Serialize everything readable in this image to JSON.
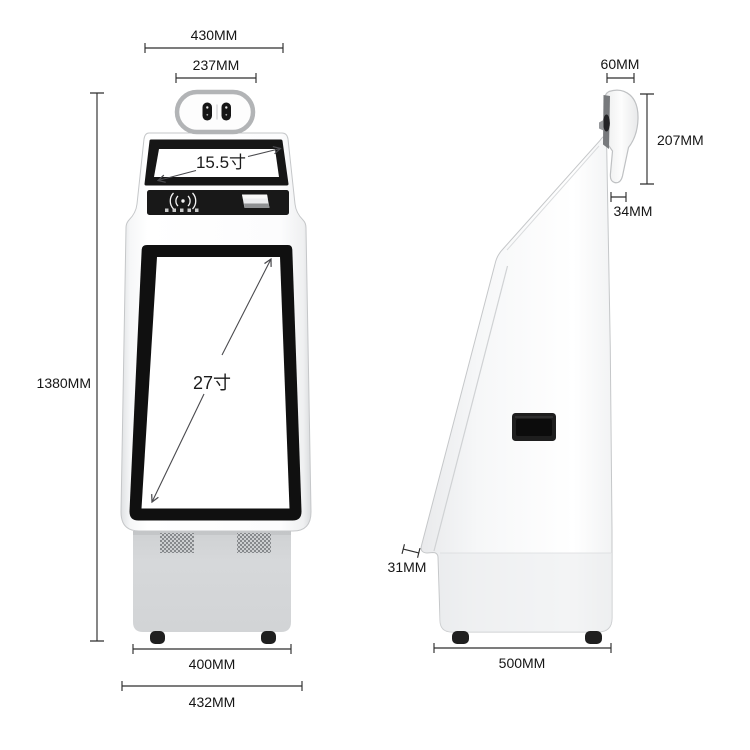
{
  "diagram": {
    "title": "self-service kiosk dimension drawing",
    "front_view": {
      "dim_top_outer": "430MM",
      "dim_camera_width": "237MM",
      "dim_total_height": "1380MM",
      "dim_base_width": "400MM",
      "dim_bottom_width": "432MM",
      "top_screen_size": "15.5寸",
      "main_screen_size": "27寸"
    },
    "side_view": {
      "dim_head_depth": "60MM",
      "dim_head_height": "207MM",
      "dim_neck_width": "34MM",
      "dim_screen_edge": "31MM",
      "dim_base_depth": "500MM"
    },
    "colors": {
      "background": "#ffffff",
      "kiosk_body": "#fbfcfd",
      "screen_bezel": "#121212",
      "base_gray": "#d4d6d8",
      "dimension_line": "#2e2e2e",
      "outline_gray": "#c5c7c9"
    },
    "icons": {
      "camera_module": "dual-lens-camera-icon",
      "nfc_reader": "contactless-payment-icon",
      "receipt_printer": "receipt-slot",
      "speakers": "speaker-grille-icon"
    }
  }
}
